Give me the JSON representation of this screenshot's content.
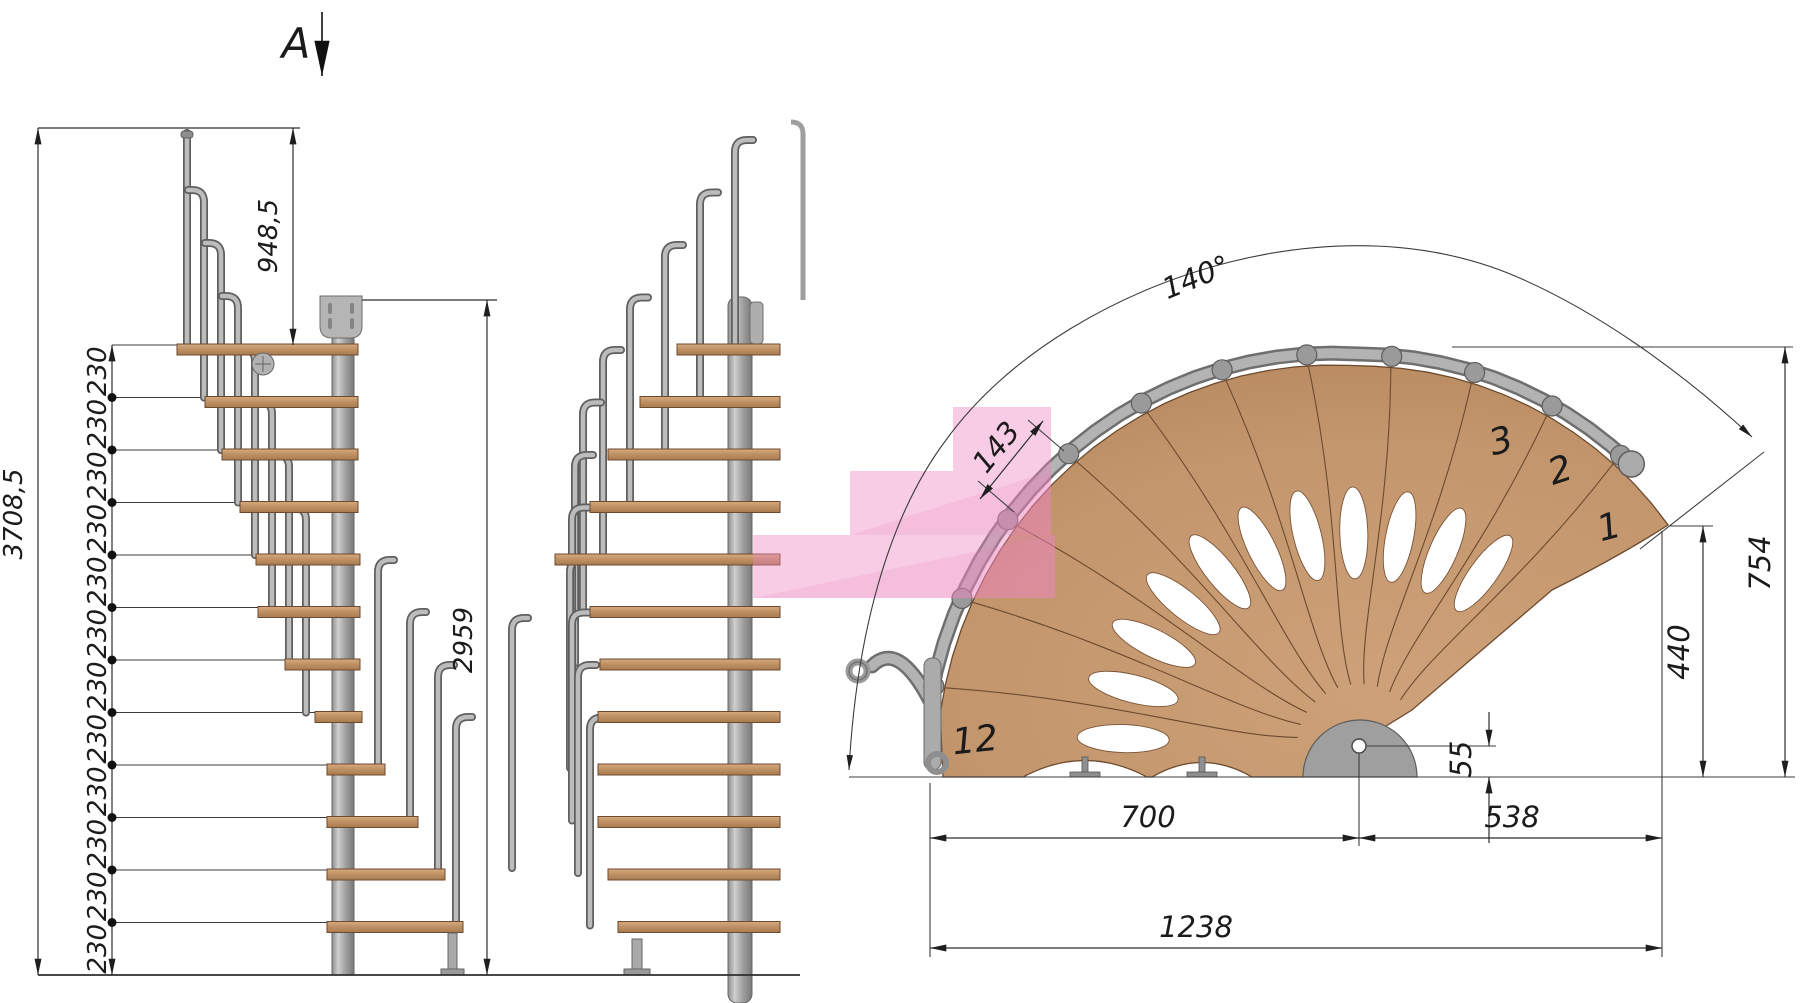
{
  "drawing": {
    "section_marker": "A",
    "elevation_side": {
      "overall_height": "3708,5",
      "top_segment": "948,5",
      "riser_height": "230",
      "riser_count": 12
    },
    "elevation_front": {
      "rail_height": "2959"
    },
    "plan": {
      "rotation_angle": "140°",
      "tread_going": "143",
      "outer_radius": "754",
      "tread_width": "440",
      "center_offset": "55",
      "span_left": "700",
      "span_right": "538",
      "total_span": "1238",
      "step_first": "1",
      "step_second": "2",
      "step_third": "3",
      "step_last": "12"
    },
    "colors": {
      "wood": "#c59a72",
      "steel": "#a9a9a9",
      "highlight_pink": "#ef86c0",
      "line": "#2e2e2e"
    }
  }
}
